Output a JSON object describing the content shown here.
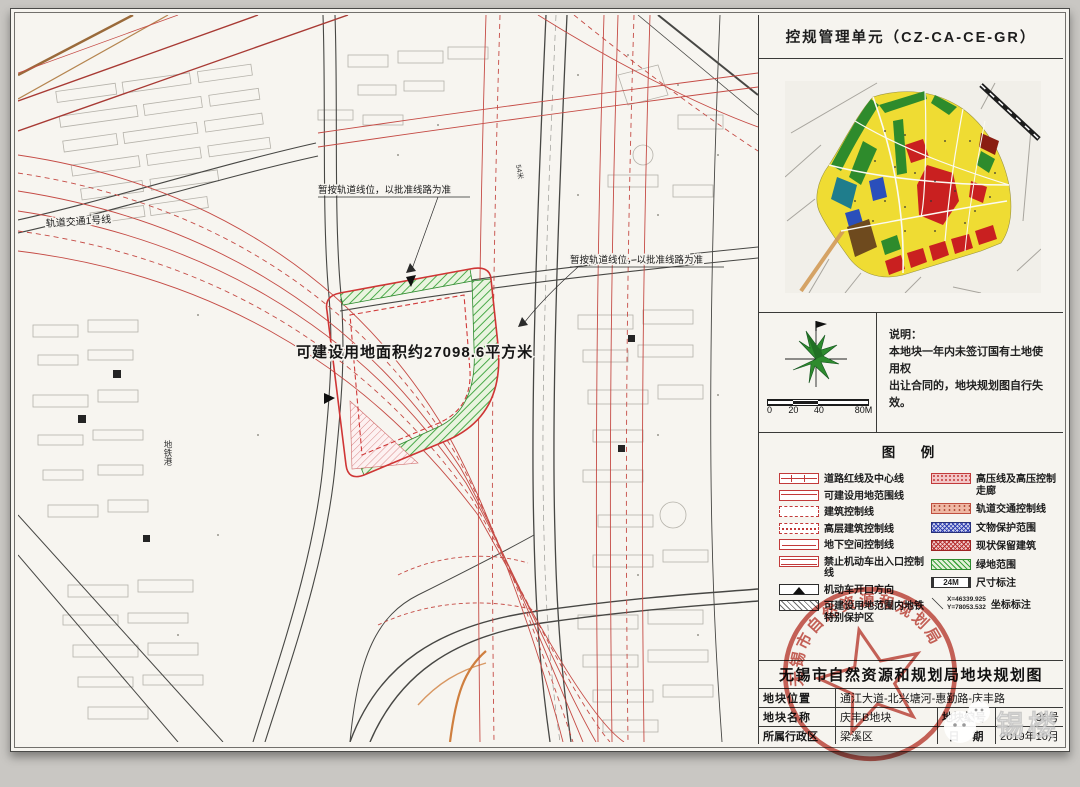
{
  "doc": {
    "unit_title": "控规管理单元（CZ-CA-CE-GR）",
    "bureau_title": "无锡市自然资源和规划局地块规划图"
  },
  "map": {
    "labels": {
      "rail_line1": "轨道交通1号线",
      "rail_temp_note": "暂按轨道线位，以批准线路为准",
      "area_note": "可建设用地面积约27098.6平方米",
      "metro_port": "地铁港",
      "dim_54": "54米"
    }
  },
  "note": {
    "title": "说明：",
    "line1": "本地块一年内未签订国有土地使用权",
    "line2": "出让合同的，地块规划图自行失效。",
    "scale_ticks": [
      "0",
      "20",
      "40",
      "80M"
    ]
  },
  "legend": {
    "title": "图　例",
    "left": [
      {
        "label": "道路红线及中心线"
      },
      {
        "label": "可建设用地范围线"
      },
      {
        "label": "建筑控制线"
      },
      {
        "label": "高层建筑控制线"
      },
      {
        "label": "地下空间控制线"
      },
      {
        "label": "禁止机动车出入口控制线"
      },
      {
        "label": "机动车开口方向"
      },
      {
        "label": "可建设用地范围内地铁特别保护区"
      }
    ],
    "right": [
      {
        "label": "高压线及高压控制走廊"
      },
      {
        "label": "轨道交通控制线"
      },
      {
        "label": "文物保护范围"
      },
      {
        "label": "现状保留建筑"
      },
      {
        "label": "绿地范围"
      },
      {
        "label": "尺寸标注",
        "swatch_text": "24M"
      },
      {
        "label": "坐标标注",
        "coord_x": "X=46339.925",
        "coord_y": "Y=78053.532"
      }
    ]
  },
  "seal": {
    "text": "无锡市自然资源和规划局"
  },
  "table": {
    "location_label": "地块位置",
    "location_value": "通江大道-北兴塘河-惠勤路-庆丰路",
    "name_label": "地块名称",
    "name_value": "庆丰B地块",
    "number_label": "地块编号",
    "number_value": "36号",
    "district_label": "所属行政区",
    "district_value": "梁溪区",
    "date_label": "日　期",
    "date_value": "2019年10月"
  },
  "watermark": {
    "text": "锡楼"
  },
  "colors": {
    "plot_red": "#cf3535",
    "green_hatch": "#3aa23a",
    "seal_red": "#bf4238",
    "inset_yellow": "#efdc33",
    "inset_red": "#c92020"
  }
}
